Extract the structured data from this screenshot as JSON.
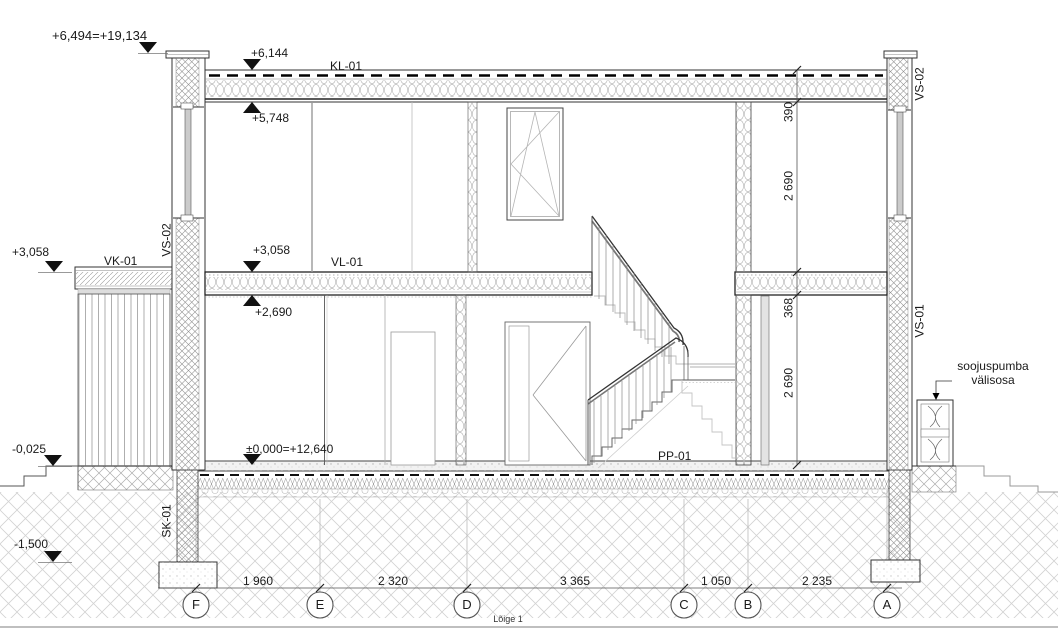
{
  "drawing": {
    "title": "Lõige 1",
    "levels": {
      "parapet": "+6,494=+19,134",
      "roof_top": "+6,144",
      "roof_soffit": "+5,748",
      "second_floor_ext": "+3,058",
      "second_floor": "+3,058",
      "first_ceiling": "+2,690",
      "ground_floor": "±0,000=+12,640",
      "terrace": "-0,025",
      "footing": "-1,500"
    },
    "tags": {
      "roof": "KL-01",
      "canopy": "VK-01",
      "wall_upper_left": "VS-02",
      "wall_upper_right": "VS-02",
      "wall_lower_right": "VS-01",
      "intermediate_floor": "VL-01",
      "plinth": "SK-01",
      "ground_slab": "PP-01"
    },
    "notes": {
      "heat_pump_line1": "soojuspumba",
      "heat_pump_line2": "välisosa"
    },
    "vertical_dimensions": [
      "390",
      "2 690",
      "368",
      "2 690"
    ],
    "grid": {
      "bubbles": [
        "F",
        "E",
        "D",
        "C",
        "B",
        "A"
      ],
      "spacings": [
        "1 960",
        "2 320",
        "3 365",
        "1 050",
        "2 235"
      ]
    },
    "colors": {
      "line": "#1a1a1a",
      "hatch": "#8f8f8f",
      "glazing": "#c9c9c9"
    }
  }
}
